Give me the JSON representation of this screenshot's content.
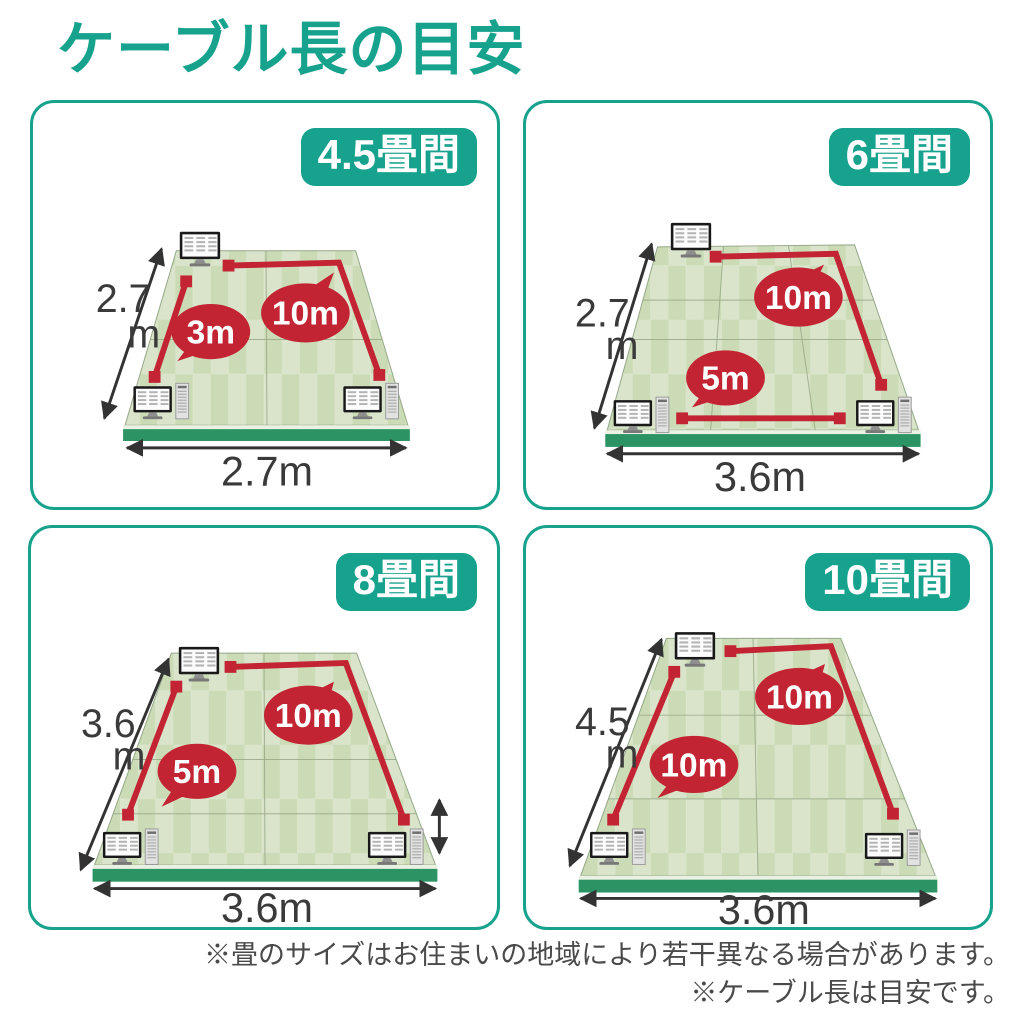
{
  "title": "ケーブル長の目安",
  "colors": {
    "accent_teal": "#17a28d",
    "cable_red": "#c32433",
    "floor_light_green": "#dae4cb",
    "floor_dark_green": "#cbdbb6",
    "base_green": "#2b9364",
    "dimension_text": "#3a3a3a"
  },
  "icons": {
    "monitor": "monitor-icon",
    "desktop_pc": "desktop-pc-icon",
    "dimension_arrow": "double-headed-arrow"
  },
  "panels": [
    {
      "badge": "4.5畳間",
      "side_value": "2.7",
      "side_unit": "m",
      "bottom_label": "2.7m",
      "cable_short": "3m",
      "cable_long": "10m"
    },
    {
      "badge": "6畳間",
      "side_value": "2.7",
      "side_unit": "m",
      "bottom_label": "3.6m",
      "cable_short": "5m",
      "cable_long": "10m"
    },
    {
      "badge": "8畳間",
      "side_value": "3.6",
      "side_unit": "m",
      "bottom_label": "3.6m",
      "cable_short": "5m",
      "cable_long": "10m"
    },
    {
      "badge": "10畳間",
      "side_value": "4.5",
      "side_unit": "m",
      "bottom_label": "3.6m",
      "cable_short": "10m",
      "cable_long": "10m"
    }
  ],
  "footnotes": [
    "※畳のサイズはお住まいの地域により若干異なる場合があります。",
    "※ケーブル長は目安です。"
  ]
}
